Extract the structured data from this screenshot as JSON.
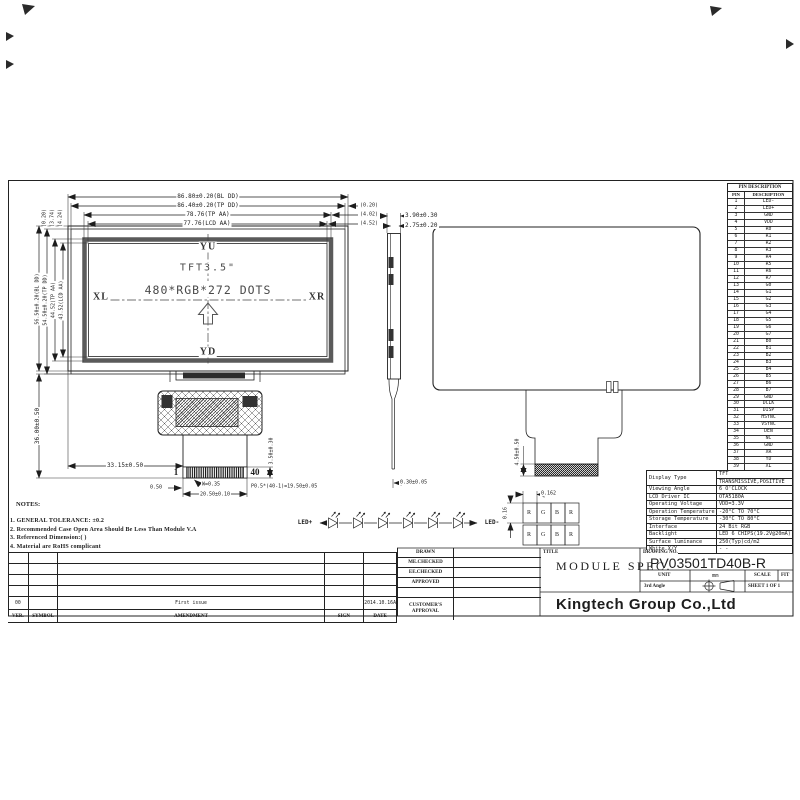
{
  "ink": "#1d1d1d",
  "paper": "#ffffff",
  "drawing": {
    "front_view": {
      "dims_top": [
        "86.80±0.20(BL DD)",
        "86.40±0.20(TP DD)",
        "78.76(TP AA)",
        "77.76(LCD AA)"
      ],
      "dims_right": [
        "(0.20)",
        "(4.02)",
        "(4.52)"
      ],
      "dims_left": [
        "56.50±0.20(BL DD)",
        "54.50±0.20(TP DD)",
        "44.52(TP AA)",
        "43.52(LCD AA)"
      ],
      "dims_left_top": [
        "(0.20)",
        "(3.74)",
        "(4.24)"
      ],
      "dim_flex_height": "36.00±0.50",
      "screen_labels": {
        "top": "YU",
        "bottom": "YD",
        "left": "XL",
        "right": "XR",
        "line1": "TFT3.5\"",
        "line2": "480*RGB*272 DOTS"
      },
      "connector": {
        "pin_first": "1",
        "pin_last": "40",
        "dim_offset": "33.15±0.50",
        "dim_w": "W=0.35",
        "dim_margin": "0.50",
        "dim_width": "20.50±0.10",
        "dim_pitch": "P0.5*(40-1)=19.50±0.05",
        "dim_height": "3.50±0.30",
        "dim_thickness": "0.30±0.05"
      }
    },
    "side_view": {
      "dims": [
        "3.90±0.30",
        "2.75±0.20"
      ]
    },
    "rear_view": {
      "dim_connector": "4.50±0.50"
    },
    "pixel_detail": {
      "dim_w": "0.162",
      "dim_h": "0.16",
      "cells": [
        "R",
        "G",
        "B",
        "R"
      ]
    },
    "led_circuit": {
      "left": "LED+",
      "right": "LED-",
      "count": 6
    }
  },
  "notes": {
    "title": "NOTES:",
    "items": [
      "1. GENERAL TOLERANCE: ±0.2",
      "2. Recommended Case Open Area Should Be Less Than Module V.A",
      "3. Referenced Dimension:(  )",
      "4. Material are RoHS complicant"
    ]
  },
  "pin_table": {
    "title": "PIN DESCRIPTION",
    "headers": [
      "PIN",
      "DESCRIPTION"
    ],
    "rows": [
      [
        "1",
        "LED-"
      ],
      [
        "2",
        "LED+"
      ],
      [
        "3",
        "GND"
      ],
      [
        "4",
        "VDD"
      ],
      [
        "5",
        "R0"
      ],
      [
        "6",
        "R1"
      ],
      [
        "7",
        "R2"
      ],
      [
        "8",
        "R3"
      ],
      [
        "9",
        "R4"
      ],
      [
        "10",
        "R5"
      ],
      [
        "11",
        "R6"
      ],
      [
        "12",
        "R7"
      ],
      [
        "13",
        "G0"
      ],
      [
        "14",
        "G1"
      ],
      [
        "15",
        "G2"
      ],
      [
        "16",
        "G3"
      ],
      [
        "17",
        "G4"
      ],
      [
        "18",
        "G5"
      ],
      [
        "19",
        "G6"
      ],
      [
        "20",
        "G7"
      ],
      [
        "21",
        "B0"
      ],
      [
        "22",
        "B1"
      ],
      [
        "23",
        "B2"
      ],
      [
        "24",
        "B3"
      ],
      [
        "25",
        "B4"
      ],
      [
        "26",
        "B5"
      ],
      [
        "27",
        "B6"
      ],
      [
        "28",
        "B7"
      ],
      [
        "29",
        "GND"
      ],
      [
        "30",
        "DCLK"
      ],
      [
        "31",
        "DISP"
      ],
      [
        "32",
        "HSYNC"
      ],
      [
        "33",
        "VSYNC"
      ],
      [
        "34",
        "DEN"
      ],
      [
        "35",
        "NC"
      ],
      [
        "36",
        "GND"
      ],
      [
        "37",
        "XR"
      ],
      [
        "38",
        "YD"
      ],
      [
        "39",
        "XL"
      ],
      [
        "40",
        "YU"
      ]
    ]
  },
  "spec_table": {
    "rows": [
      [
        "Display Type",
        "TFT",
        "TRANSMISSIVE,POSITIVE"
      ],
      [
        "Viewing Angle",
        "6 O'CLOCK"
      ],
      [
        "LCD Driver IC",
        "OTA5180A"
      ],
      [
        "Operating Voltage",
        "VDD=3.3V"
      ],
      [
        "Operation Temperature",
        "-20°C TO 70°C"
      ],
      [
        "Storage Temperature",
        "-30°C TO 80°C"
      ],
      [
        "Interface",
        "24 Bit RGB"
      ],
      [
        "Backlight",
        "LED 6 CHIPS(19.2V@20mA)"
      ],
      [
        "Surface luminance",
        "250(Typ)cd/m2"
      ],
      [
        "White X/Y",
        "- -"
      ]
    ]
  },
  "title_block": {
    "approval_rows": [
      "DRAWN",
      "ME.CHECKED",
      "EE.CHECKED",
      "APPROVED"
    ],
    "customer_row": "CUSTOMER'S APPROVAL",
    "title_label": "TITLE",
    "title": "MODULE SPEC.",
    "drawing_no_label": "DRAWING NO.",
    "drawing_no": "PV03501TD40B-R",
    "unit_label": "UNIT",
    "unit_value": "mm",
    "scale_label": "SCALE",
    "scale_value": "FIT",
    "angle_label": "3rd Angle",
    "sheet": "SHEET 1 OF 1",
    "company": "Kingtech Group Co.,Ltd"
  },
  "revision_table": {
    "headers": [
      "VER.",
      "SYMBOL",
      "AMENDMENT",
      "SIGN",
      "DATE"
    ],
    "entry": {
      "ver": "00",
      "symbol": "",
      "amendment": "First issue",
      "sign": "",
      "date": "2014.10.16A"
    }
  }
}
